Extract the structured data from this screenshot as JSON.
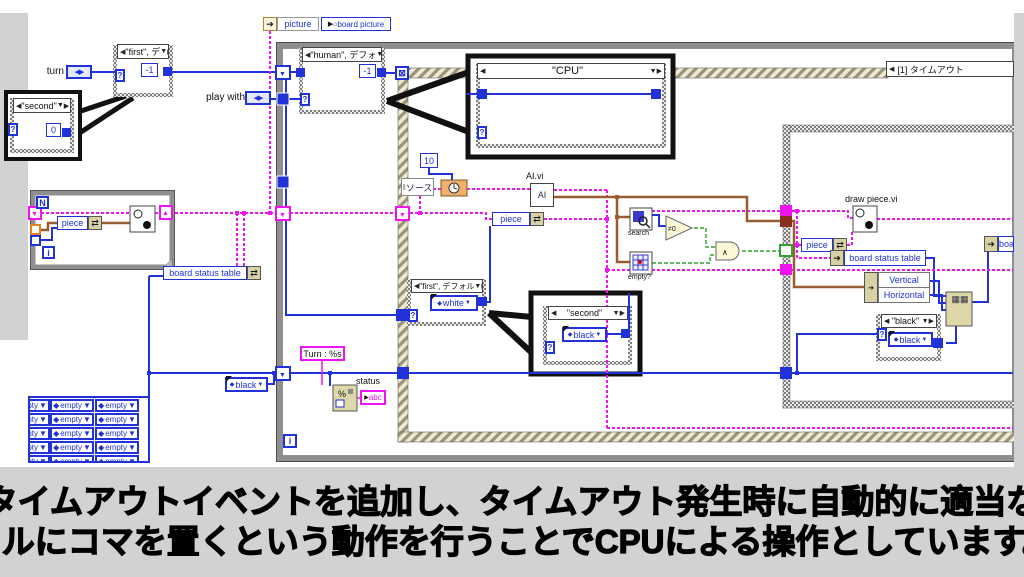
{
  "caption": {
    "line1": "タイムアウトイベントを追加し、タイムアウト発生時に自動的に適当な",
    "line2": "セルにコマを置くという動作を行うことでCPUによる操作としています。"
  },
  "header": {
    "picture_label": "picture",
    "property_node_label": "board picture",
    "property_node_prefix": "▶⌂"
  },
  "terminals": {
    "turn": "turn",
    "play_with": "play with",
    "status": "status",
    "enum_glyph": "◀▶"
  },
  "event_structure": {
    "case_label": "[1] タイムアウト",
    "data_node_label": "ソース",
    "timeout_glyph": "⊠"
  },
  "case_selectors": {
    "first_top": "\"first\", デ",
    "human": "\"human\", デフォ",
    "cpu": "\"CPU\"",
    "second": "\"second\"",
    "first_default": "\"first\", デフォル",
    "black": "\"black\""
  },
  "constants": {
    "minus_one": "-1",
    "zero": "0",
    "ten": "10",
    "white": "white",
    "black": "black",
    "empty": "empty",
    "turn_format": "Turn : %s"
  },
  "nodes": {
    "ai_vi_label": "AI.vi",
    "ai_icon_text": "AI",
    "draw_piece_label": "draw piece.vi",
    "search_label": "search",
    "empty_q_label": "empty?",
    "piece": "piece",
    "board_status_table": "board status table",
    "board_clipped": "boar",
    "vertical": "Vertical",
    "horizontal": "Horizontal",
    "status_indicator_text": "abc",
    "format_glyph": "%",
    "replace_array_glyph": "▦▦",
    "bundle_glyph": "⇄",
    "local_var_glyph": "➔",
    "and_glyph": "∧",
    "neq_glyph": "≠0"
  },
  "loops": {
    "count_glyph": "N",
    "iter_glyph": "i",
    "selector_glyph": "?"
  },
  "icons": {
    "left": "◀",
    "right": "▶",
    "down": "▼",
    "diamond": "◆"
  },
  "empty_array": {
    "rows": 5,
    "cols": 3,
    "col_x": [
      -24,
      20,
      65
    ],
    "row_h": 14
  },
  "colors": {
    "wire_int_blue": "#2132d8",
    "wire_cluster_pink": "#f213f2",
    "wire_cluster_brown": "#995c31",
    "wire_bool_green": "#33a033",
    "structure_gray": "#8f8f8f",
    "hatch_tan": "#9a927a",
    "node_tan": "#ddd5a6",
    "background_gray": "#d2d2d2"
  }
}
